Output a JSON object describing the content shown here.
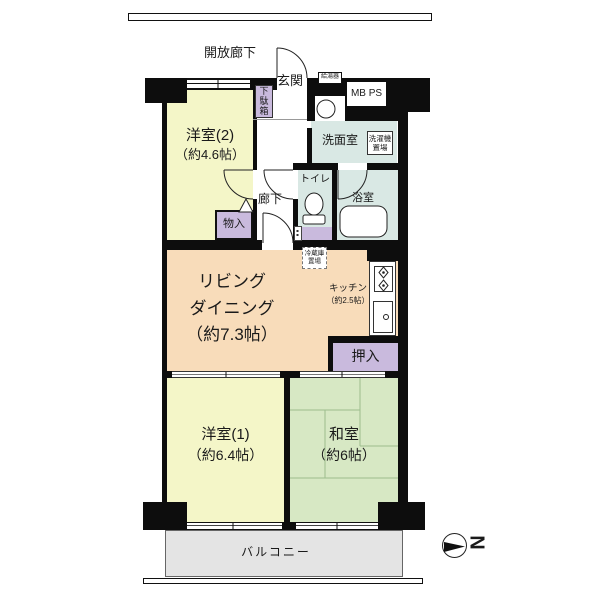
{
  "exterior": {
    "open_corridor": "開放廊下",
    "balcony": "バルコニー",
    "mb_ps": "MB PS",
    "water_heater": "給湯器"
  },
  "compass": {
    "letter": "N"
  },
  "entry": {
    "entrance": "玄関",
    "shoe_cabinet": "下駄箱",
    "hallway": "廊下"
  },
  "sanitary": {
    "washroom": "洗面室",
    "washer_space": "洗濯機置場",
    "toilet": "トイレ",
    "bath": "浴室"
  },
  "storage": {
    "hall_closet": "物入",
    "oshiire": "押入",
    "fridge_space": "冷蔵庫置場"
  },
  "rooms": {
    "western2": {
      "name": "洋室(2)",
      "size": "（約4.6帖）"
    },
    "living": {
      "name1": "リビング",
      "name2": "ダイニング",
      "size": "（約7.3帖）"
    },
    "kitchen": {
      "name": "キッチン",
      "size": "（約2.5帖）"
    },
    "western1": {
      "name": "洋室(1)",
      "size": "（約6.4帖）"
    },
    "japanese": {
      "name": "和室",
      "size": "（約6帖）"
    }
  },
  "colors": {
    "western_room": "#f4f6c8",
    "japanese_room": "#d7e8c4",
    "living_dining": "#f8dcba",
    "storage_purple": "#c9badd",
    "wet_area_blue": "#d9e8e4",
    "balcony_gray": "#e4e4e4",
    "wall_black": "#0d0d0d"
  }
}
